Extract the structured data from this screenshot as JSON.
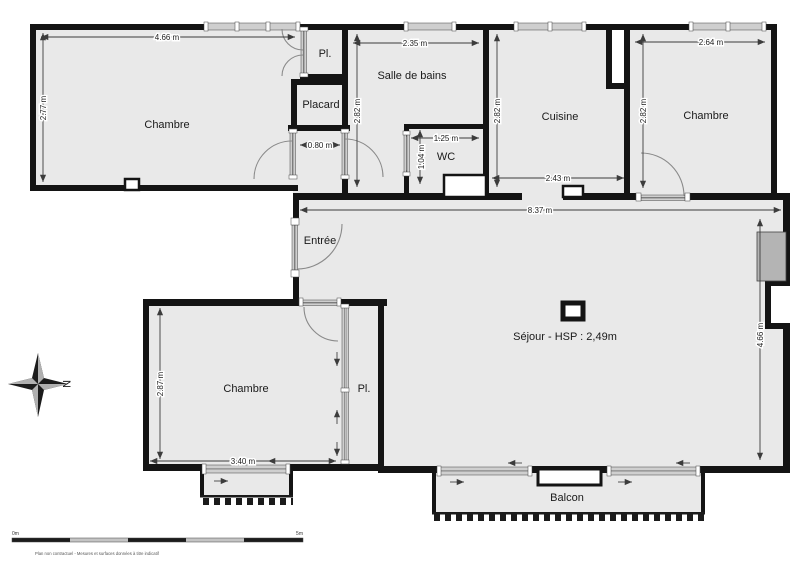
{
  "rooms": {
    "chambre_tl": "Chambre",
    "closet_top": "Pl.",
    "placard": "Placard",
    "salle_de_bains": "Salle de bains",
    "wc": "WC",
    "cuisine": "Cuisine",
    "chambre_tr": "Chambre",
    "entree": "Entrée",
    "sejour": "Séjour - HSP : 2,49m",
    "chambre_bl": "Chambre",
    "closet_bl": "Pl.",
    "balcon": "Balcon"
  },
  "dimensions": {
    "chambre_tl_width": "4.66 m",
    "chambre_tl_height": "2.77 m",
    "passage_width": "0.80 m",
    "sdb_width": "2.35 m",
    "sdb_height": "2.82 m",
    "wc_width": "1.25 m",
    "wc_height": "1.04 m",
    "cuisine_height": "2.82 m",
    "cuisine_width": "2.43 m",
    "chambre_tr_width": "2.64 m",
    "chambre_tr_height": "2.82 m",
    "sejour_width": "8.37 m",
    "sejour_height": "4.66 m",
    "chambre_bl_height": "2.87 m",
    "chambre_bl_width": "3.40 m"
  },
  "compass": {
    "north_label": "N"
  },
  "scale_bar": {
    "start_label": "0m",
    "end_label": "5m"
  },
  "footer_note": "Plan non contractuel - Mesures et surfaces données à titre indicatif",
  "colors": {
    "wall": "#141414",
    "room_fill": "#e9e9e9",
    "radiator": "#b4b4b4",
    "window_rail": "#cfcfcf"
  }
}
